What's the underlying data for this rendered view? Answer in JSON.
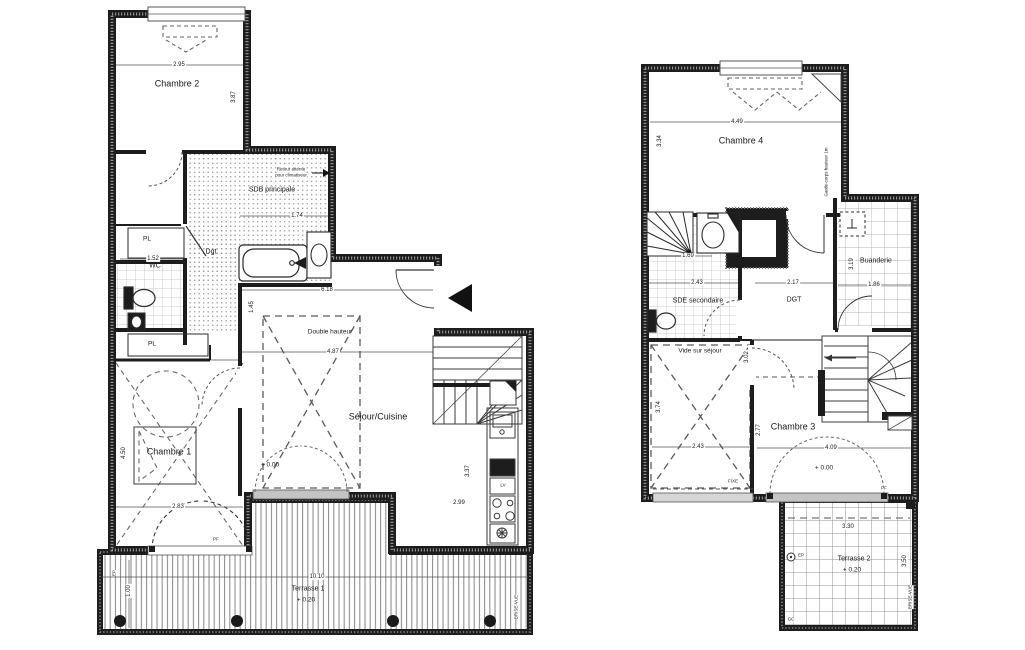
{
  "L": {
    "rooms": {
      "chambre2": "Chambre 2",
      "sdb": "SDB principale",
      "wc": "WC",
      "dgt": "Dgt",
      "pl_top": "PL",
      "pl_bottom": "PL",
      "chambre1": "Chambre 1",
      "sejour": "Séjour/Cuisine",
      "terrasse": "Terrasse 1"
    },
    "notes": {
      "double_hauteur": "Double hauteur",
      "level_zero": "+ 0.00",
      "terrasse_level": "+ 0.20",
      "vent_line1": "Retour attente",
      "vent_line2": "pour climatiseur",
      "lv": "LV",
      "pf": "PF",
      "ep": "EP",
      "brise_vue": "BRISE-VUE"
    },
    "dims": {
      "chambre2_w": "2.95",
      "chambre2_h": "3.87",
      "sdb_w": "1.74",
      "wc_w": "1.52",
      "sejour_w": "6.18",
      "dh_w": "4.87",
      "dh_h": "1.45",
      "chambre1_h": "4.50",
      "chambre1_w": "2.83",
      "kitchen_h": "3.37",
      "kitchen_w": "2.99",
      "terrasse_w": "10.10",
      "terrasse_d": "1.00"
    }
  },
  "R": {
    "rooms": {
      "chambre4": "Chambre 4",
      "sde": "SDE secondaire",
      "dgt": "DGT",
      "buanderie": "Buanderie",
      "vide": "Vide sur séjour",
      "chambre3": "Chambre 3",
      "terrasse": "Terrasse 2"
    },
    "notes": {
      "level_zero": "+ 0.00",
      "terrasse_level": "+ 0.20",
      "fixe": "FIXE",
      "pf": "PF",
      "garde_corps": "Garde-corps hauteur 1m",
      "ep": "EP",
      "gc": "GC",
      "brise_vue": "BRISE-VUE"
    },
    "dims": {
      "chambre4_w": "4.49",
      "chambre4_h": "3.34",
      "sde_n": "1.69",
      "sde_w": "2.43",
      "dgt_w": "2.17",
      "buanderie_w": "1.86",
      "buanderie_h": "3.19",
      "vide_h": "3.74",
      "vide_w": "2.43",
      "chambre3_w": "4.09",
      "chambre3_h": "2.77",
      "chambre3_h2": "3.02",
      "terrasse_w": "3.30",
      "terrasse_h": "3.50"
    }
  }
}
